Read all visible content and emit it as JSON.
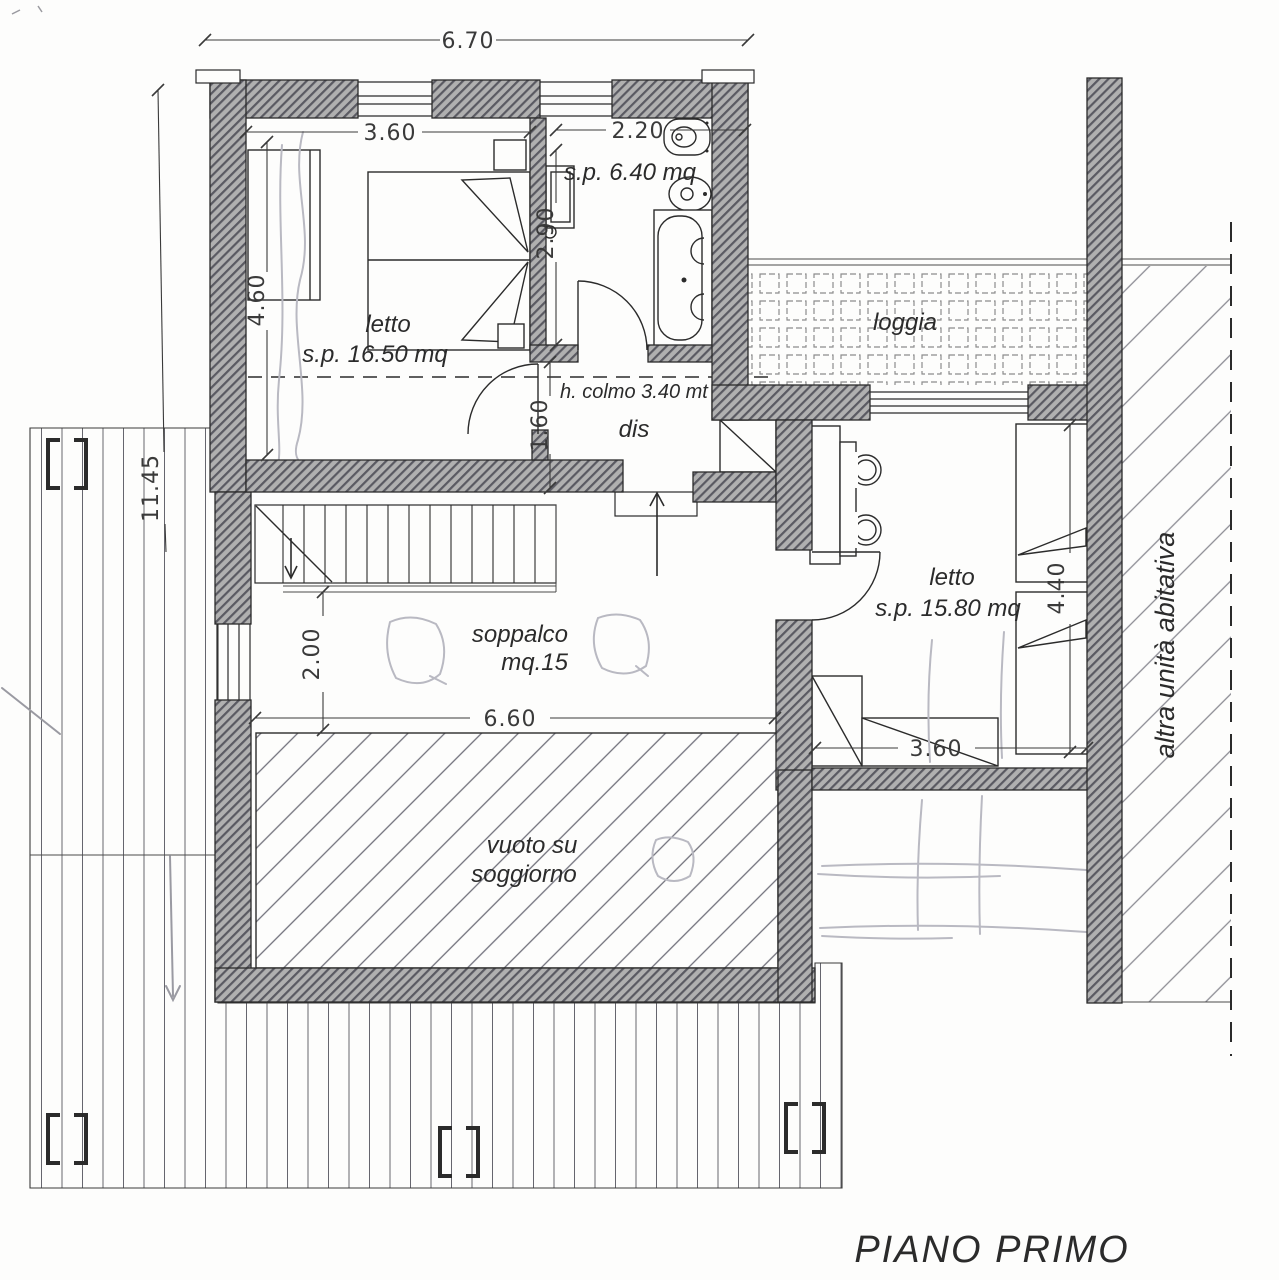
{
  "title": "PIANO PRIMO",
  "rooms": {
    "bedroom1": {
      "name": "letto",
      "area": "s.p. 16.50 mq"
    },
    "bathroom": {
      "area": "s.p. 6.40 mq"
    },
    "hallway": {
      "name": "dis"
    },
    "loggia": {
      "name": "loggia"
    },
    "bedroom2": {
      "name": "letto",
      "area": "s.p. 15.80 mq"
    },
    "mezzanine": {
      "name": "soppalco",
      "area": "mq.15"
    },
    "void": {
      "line1": "vuoto su",
      "line2": "soggiorno"
    },
    "adjacent_unit": {
      "name": "altra unità abitativa"
    }
  },
  "annotations": {
    "ridge_height": "h. colmo 3.40 mt"
  },
  "dimensions": {
    "overall_width": "6.70",
    "bedroom1_width": "3.60",
    "bathroom_width": "2.20",
    "bedroom1_depth": "4.60",
    "bathroom_depth": "2.90",
    "hallway_depth": "1.60",
    "left_total": "11.45",
    "mezzanine_depth": "2.00",
    "mezzanine_width": "6.60",
    "bedroom2_width": "3.60",
    "bedroom2_depth": "4.40"
  },
  "colors": {
    "ink": "#2b2b2b",
    "wall_fill": "#b0b0b0",
    "wall_stripe": "#5a5a62",
    "pencil": "#b9b9c2",
    "paper": "#fdfdfc"
  }
}
